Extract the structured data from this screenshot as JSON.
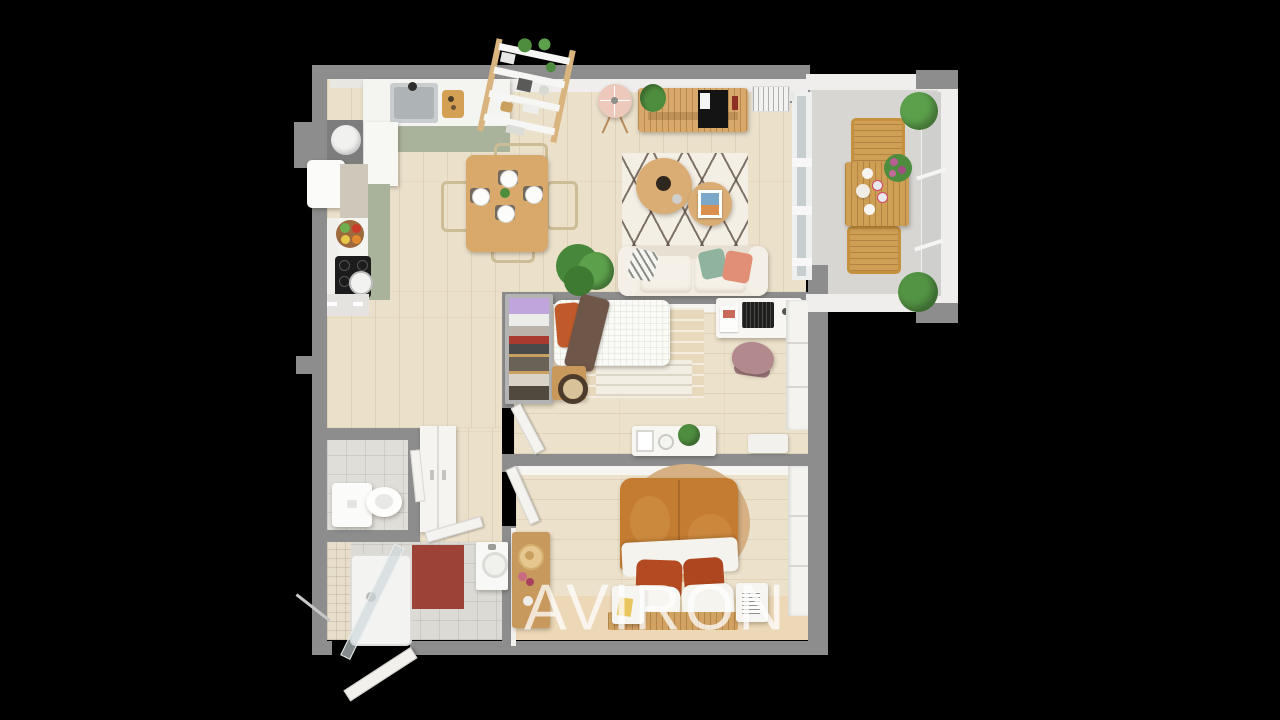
{
  "watermark": {
    "text": "AVIRON",
    "color": "#ffffff",
    "opacity": 0.75
  },
  "palette": {
    "background": "#000000",
    "wall": "#8d8d8d",
    "wall_face": "#efeeec",
    "floor_wood": "#ebe1cb",
    "floor_wood_bedroom": "#ece2cb",
    "floor_tan": "#ecd8b6",
    "floor_tile": "#dcdad5",
    "floor_balcony": "#d7d6d2",
    "kitchen_sage": "#a9b29a",
    "counter_white": "#f4f4f1",
    "wood_furniture": "#d9a96b",
    "sofa_cream": "#f1ebe1",
    "rug_white": "#f4efe5",
    "rug_lattice": "#57493e",
    "pillow_green": "#8fb39e",
    "pillow_coral": "#e28f77",
    "pillow_orange": "#c05a2a",
    "blanket_brown": "#6e5748",
    "duvet_caramel": "#c47c31",
    "pillow_rust": "#b44a22",
    "rattan": "#d6b083",
    "mat_red": "#9c4237",
    "lavender": "#c0a5dc",
    "chair_mauve": "#b28a8e",
    "lamp_pink": "#ecc9ba",
    "plant_green": "#4e8c3e",
    "glass": "#c6ced0",
    "watermark_color": "#ffffff"
  }
}
